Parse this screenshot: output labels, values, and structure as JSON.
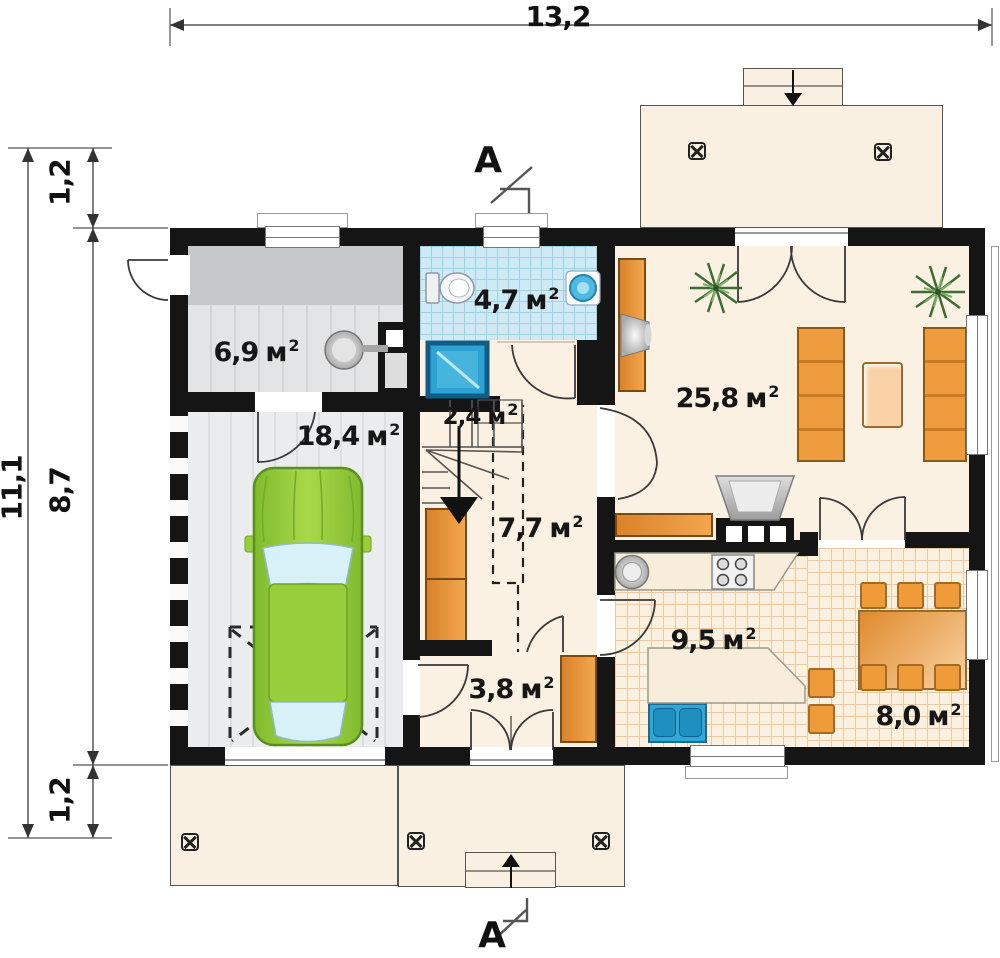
{
  "dimensions": {
    "width_top": "13,2",
    "height_total": "11,1",
    "height_top": "1,2",
    "height_middle": "8,7",
    "height_bottom": "1,2"
  },
  "units": {
    "meter": "м",
    "sup": "2"
  },
  "section": {
    "label": "A"
  },
  "rooms": {
    "utility": "6,9",
    "bathroom": "4,7",
    "garage": "18,4",
    "stairs": "2,4",
    "hall": "7,7",
    "living_room": "25,8",
    "kitchen": "9,5",
    "vestibule": "3,8",
    "dining": "8,0"
  },
  "colors": {
    "wall": "#151515",
    "floor_cream": "#faf1e2",
    "tile_blue": "#cfeaf5",
    "tile_warm": "#fbf1e0",
    "furniture_orange": "#ee9a3d",
    "car_green": "#95cb3d",
    "water_blue": "#2ea8d4",
    "floor_gray": "#e9ebed"
  }
}
